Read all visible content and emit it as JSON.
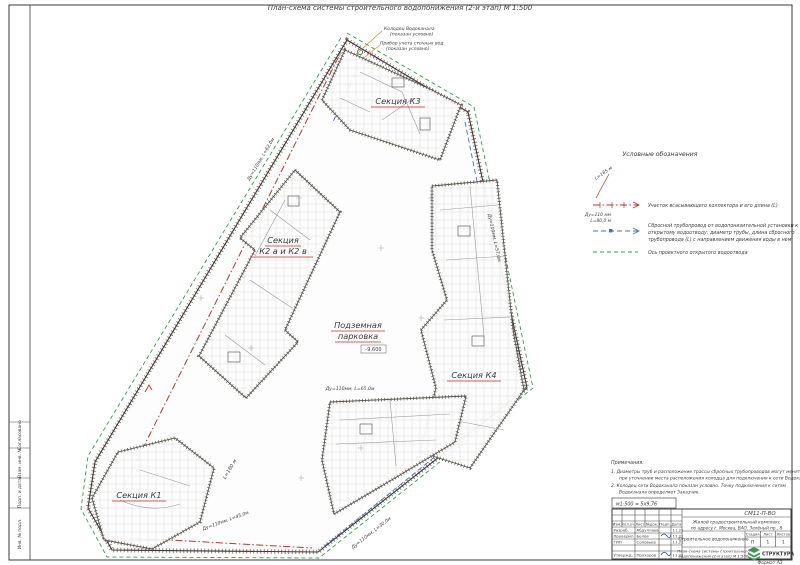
{
  "doc": {
    "title": "План-схема системы строительного водопонижения (2-й этап) М 1:500"
  },
  "plan": {
    "sections": {
      "k3": "Секция К3",
      "k2a": "Секция",
      "k2b": "К2 а и К2 в",
      "k4": "Секция К4",
      "k1": "Секция К1",
      "parking1": "Подземная",
      "parking2": "парковка"
    },
    "elevation": "-9,600",
    "collector_length": "L=180 м",
    "callouts": {
      "well1": "Колодец Водоканала",
      "well2": "(показан условно)",
      "meter1": "Прибор учета сточных вод",
      "meter2": "(показан условно)"
    },
    "dims": [
      "Ду=110мм, L=62,0м",
      "Ду=110мм, L=57,0м",
      "Ду=110мм, L=65,0м",
      "Ду=110мм, L=30,0м",
      "Ду=110мм, L=45,0м"
    ]
  },
  "legend": {
    "title": "Условные обозначения",
    "i1_ann": "L=165 м",
    "i1_label": "Участок всасывающего коллектора и его длина (L)",
    "i2_ann1": "Ду=110 мм",
    "i2_ann2": "L=80,0 м",
    "i2_l1": "Сбросной трубопровод от водопонизительной установки к",
    "i2_l2": "открытому водоотводу: диаметр трубы, длина сбросного",
    "i2_l3": "трубопровода (L) с направлением движения воды в нем",
    "i3_label": "Ось проектного открытого водоотвода"
  },
  "notes": {
    "title": "Примечания:",
    "n1a": "1.  Диаметры труб и расположение трассы сбросных трубопроводов могут меняться",
    "n1b": "при уточнении места расположения колодца для подключения к сети Водоканала.",
    "n2a": "2.  Колодец сети Водоканала показан условно. Точку подключения к сетям",
    "n2b": "Водоканала определяет Заказчик."
  },
  "scale_note": "м1:500 = 5х9,76",
  "tb": {
    "code": "СМ11-П-ВО",
    "proj1": "Жилой градостроительный комплекс",
    "proj2": "по адресу г. Москва, ВАО, Зелёный пр., 8",
    "doc_type": "Строительное водопонижение",
    "draw1": "План-схема системы строительного",
    "draw2": "водопонижения (2-й этап) М 1:500",
    "header": [
      "Изм.",
      "Кол.уч.",
      "Лист",
      "№док.",
      "Подп.",
      "Дата"
    ],
    "rows": [
      {
        "role": "Разраб.",
        "name": "Абдуллаев",
        "date": "11.21"
      },
      {
        "role": "Проверил",
        "name": "Белов",
        "date": "11.21"
      },
      {
        "role": "ГИП",
        "name": "Соловьев",
        "date": "11.21"
      },
      {
        "role": "Утвержд.",
        "name": "Прохоров",
        "date": "11.21"
      }
    ],
    "stage": [
      "Стадия",
      "Лист",
      "Листов"
    ],
    "stage_vals": [
      "П",
      "1",
      "1"
    ],
    "company": "СТРУКТУРА",
    "format": "Формат А3"
  },
  "strip": [
    "Согласовано",
    "Взам. инв. №",
    "Подп. и дата",
    "Инв. № подл."
  ],
  "colors": {
    "red": "#c03330",
    "blue": "#3a6fd8",
    "teal": "#18857a",
    "green": "#2aa04a",
    "logo_green": "#2f9e49"
  }
}
